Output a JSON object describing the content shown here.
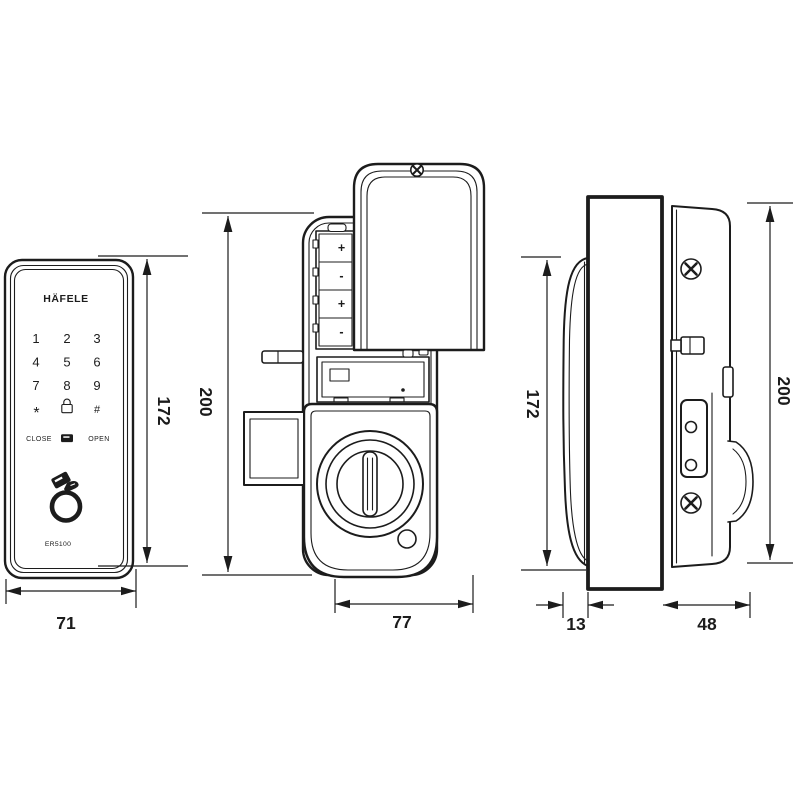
{
  "colors": {
    "ink": "#1c1c1c",
    "door_fill": "#c9c9c9",
    "background": "#ffffff"
  },
  "front_view": {
    "brand": "HÄFELE",
    "model": "ER5100",
    "keypad": {
      "digits": [
        "1",
        "2",
        "3",
        "4",
        "5",
        "6",
        "7",
        "8",
        "9"
      ],
      "star": "*",
      "hash": "#",
      "close": "CLOSE",
      "open": "OPEN"
    },
    "height_dim": "172",
    "width_dim": "71"
  },
  "back_view": {
    "battery_signs": [
      "+",
      "-",
      "+",
      "-"
    ],
    "height_dim": "200",
    "width_dim": "77"
  },
  "side_view": {
    "front_height_dim": "172",
    "back_height_dim": "200",
    "panel_depth_dim": "13",
    "body_depth_dim": "48"
  }
}
